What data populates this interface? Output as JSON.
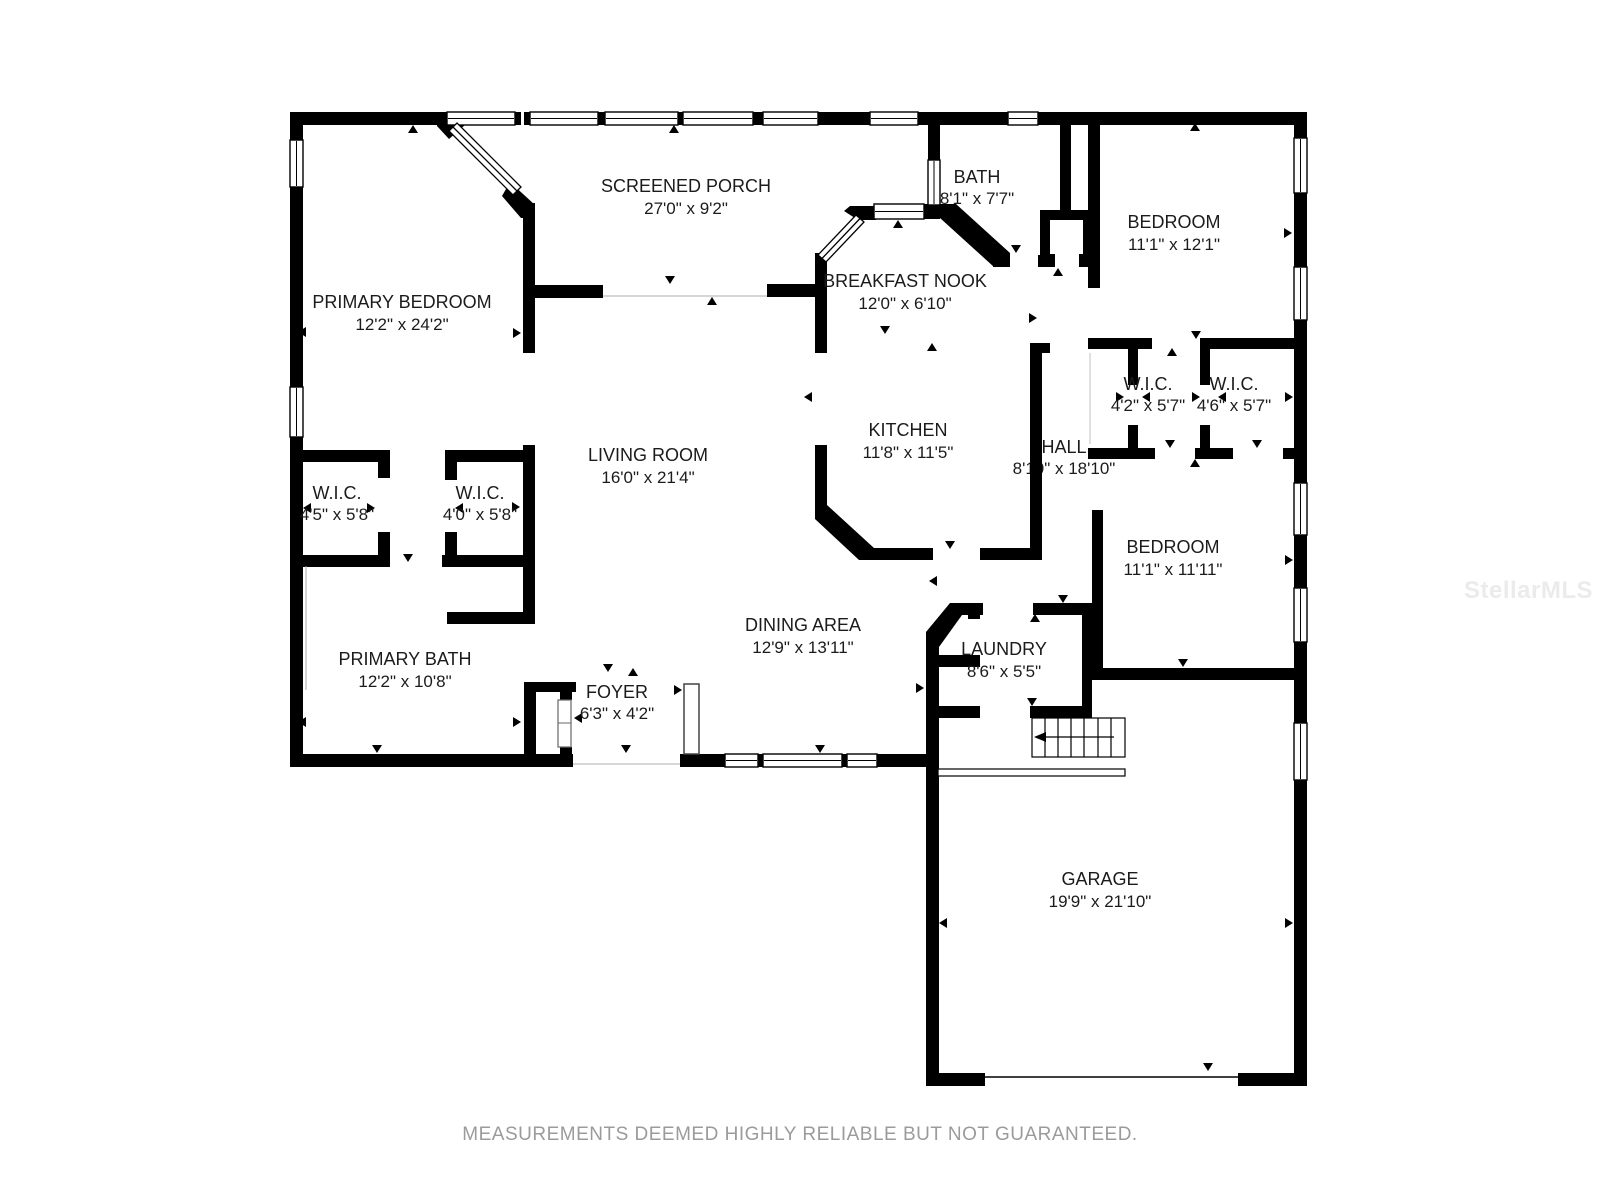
{
  "watermark": "StellarMLS",
  "disclaimer": "MEASUREMENTS DEEMED HIGHLY RELIABLE BUT NOT GUARANTEED.",
  "colors": {
    "wall": "#000000",
    "label": "#1b1b1b",
    "disclaimer_text": "#9b9b9b",
    "watermark_text": "#ebebeb",
    "background": "#ffffff"
  },
  "rooms": [
    {
      "name": "SCREENED PORCH",
      "dims": "27'0\" x 9'2\""
    },
    {
      "name": "BATH",
      "dims": "8'1\" x 7'7\""
    },
    {
      "name": "BEDROOM",
      "dims": "11'1\" x 12'1\""
    },
    {
      "name": "PRIMARY BEDROOM",
      "dims": "12'2\" x 24'2\""
    },
    {
      "name": "BREAKFAST NOOK",
      "dims": "12'0\" x 6'10\""
    },
    {
      "name": "KITCHEN",
      "dims": "11'8\" x 11'5\""
    },
    {
      "name": "HALL",
      "dims": "8'10\" x 18'10\""
    },
    {
      "name": "W.I.C.",
      "dims": "4'2\" x 5'7\""
    },
    {
      "name": "W.I.C.",
      "dims": "4'6\" x 5'7\""
    },
    {
      "name": "LIVING ROOM",
      "dims": "16'0\" x 21'4\""
    },
    {
      "name": "W.I.C.",
      "dims": "4'5\" x 5'8\""
    },
    {
      "name": "W.I.C.",
      "dims": "4'0\" x 5'8\""
    },
    {
      "name": "BEDROOM",
      "dims": "11'1\" x 11'11\""
    },
    {
      "name": "PRIMARY BATH",
      "dims": "12'2\" x 10'8\""
    },
    {
      "name": "DINING AREA",
      "dims": "12'9\" x 13'11\""
    },
    {
      "name": "LAUNDRY",
      "dims": "8'6\" x 5'5\""
    },
    {
      "name": "FOYER",
      "dims": "6'3\" x 4'2\""
    },
    {
      "name": "GARAGE",
      "dims": "19'9\" x 21'10\""
    }
  ]
}
